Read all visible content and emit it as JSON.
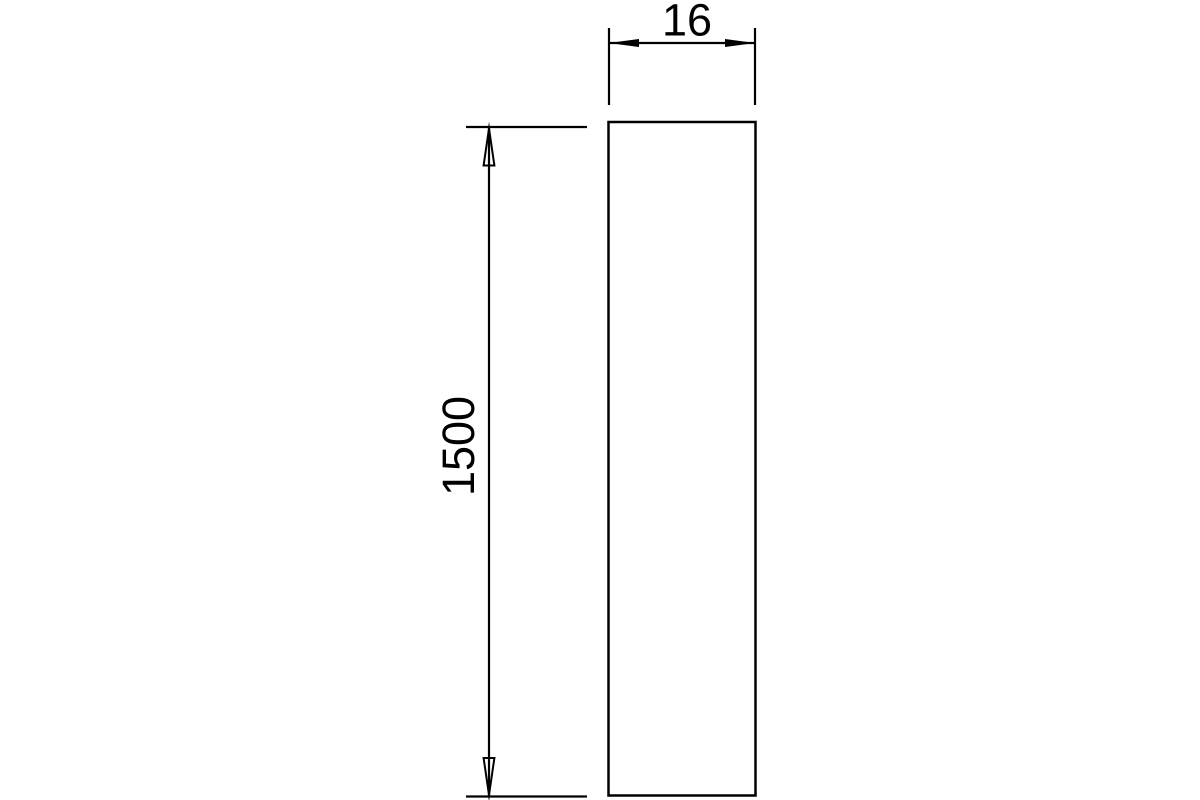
{
  "colors": {
    "background": "#ffffff",
    "line": "#000000",
    "text": "#000000"
  },
  "drawing": {
    "kind": "dimension-drawing",
    "part": {
      "shape": "rectangle"
    },
    "dimensions": {
      "width_label": "16",
      "height_label": "1500"
    }
  }
}
